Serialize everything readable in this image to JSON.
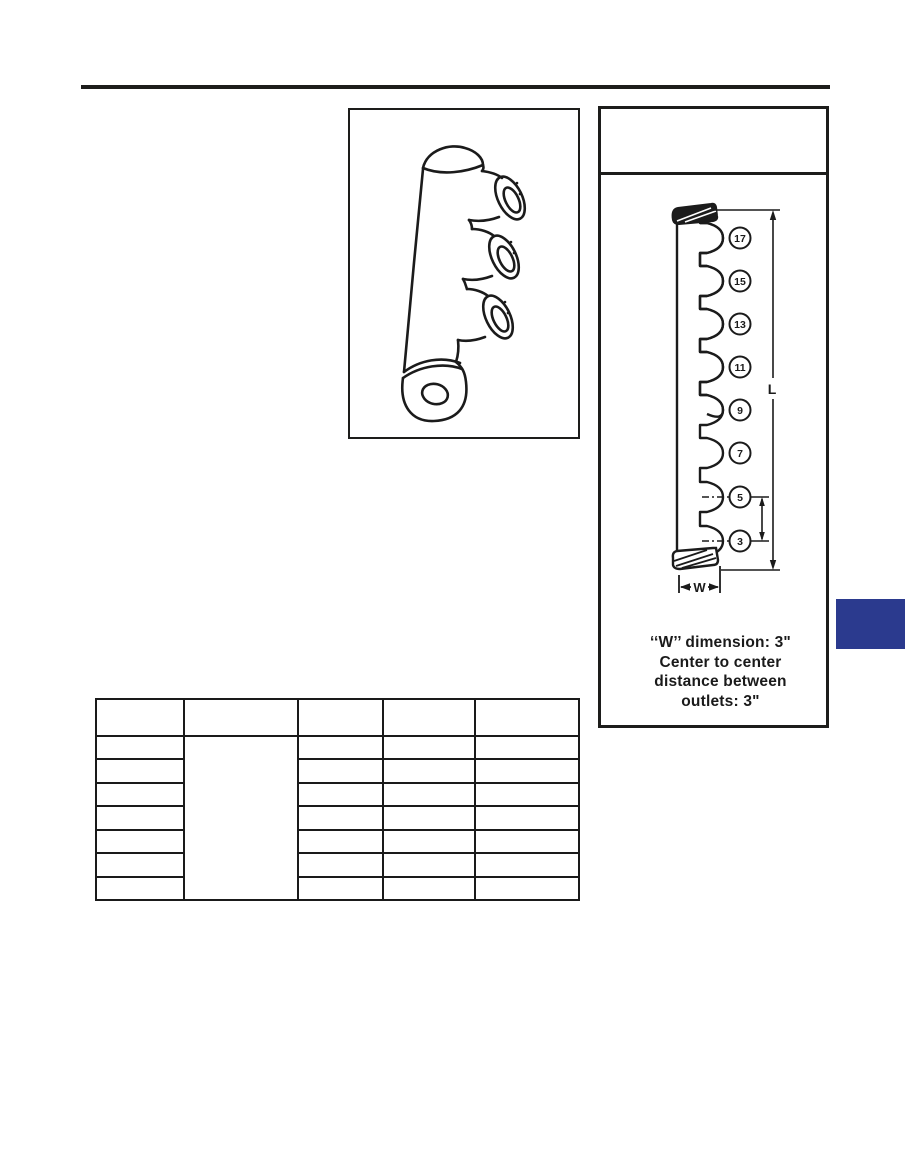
{
  "colors": {
    "ink": "#1d1d1b",
    "marker_navy": "#2b3a8e",
    "paper": "#ffffff"
  },
  "right_panel": {
    "header_text": "",
    "diagram": {
      "outlet_labels": [
        "17",
        "15",
        "13",
        "11",
        "9",
        "7",
        "5",
        "3"
      ],
      "length_dim_label": "L",
      "width_dim_label": "W"
    },
    "caption_lines": [
      "‘‘W’’ dimension: 3\"",
      "Center to center",
      "distance between",
      "outlets: 3\""
    ]
  },
  "table": {
    "header": [
      "",
      "",
      "",
      "",
      ""
    ],
    "rows": [
      [
        "",
        "",
        "",
        "",
        ""
      ],
      [
        "",
        "",
        "",
        "",
        ""
      ],
      [
        "",
        "",
        "",
        "",
        ""
      ],
      [
        "",
        "",
        "",
        "",
        ""
      ],
      [
        "",
        "",
        "",
        "",
        ""
      ],
      [
        "",
        "",
        "",
        "",
        ""
      ],
      [
        "",
        "",
        "",
        "",
        ""
      ]
    ],
    "column_2_merged_across_rows": true
  }
}
